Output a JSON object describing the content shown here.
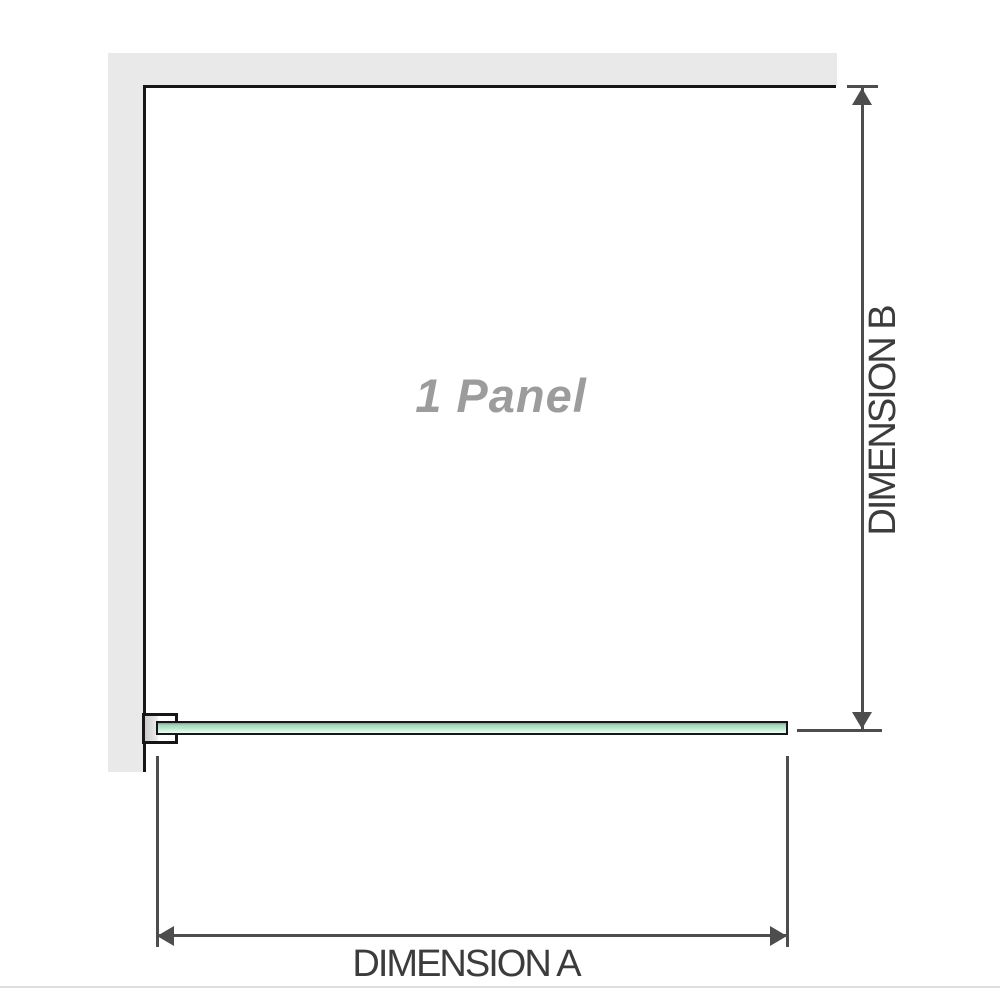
{
  "diagram": {
    "panel_label": "1 Panel",
    "dimension_a": {
      "label": "DIMENSION A"
    },
    "dimension_b": {
      "label": "DIMENSION B"
    }
  },
  "colors": {
    "background": "#ffffff",
    "wall_fill": "#e9e9e9",
    "outline": "#161616",
    "dimension_line": "#4d4d4d",
    "dimension_text": "#3c3c3c",
    "panel_label_text": "#9c9c9c",
    "bracket_fill": "#cacaca",
    "glass_green_dark": "#7fa28f",
    "glass_green_mid": "#b7e6cb",
    "glass_green_light": "#f2fbf6",
    "separator_line": "#dedede"
  }
}
